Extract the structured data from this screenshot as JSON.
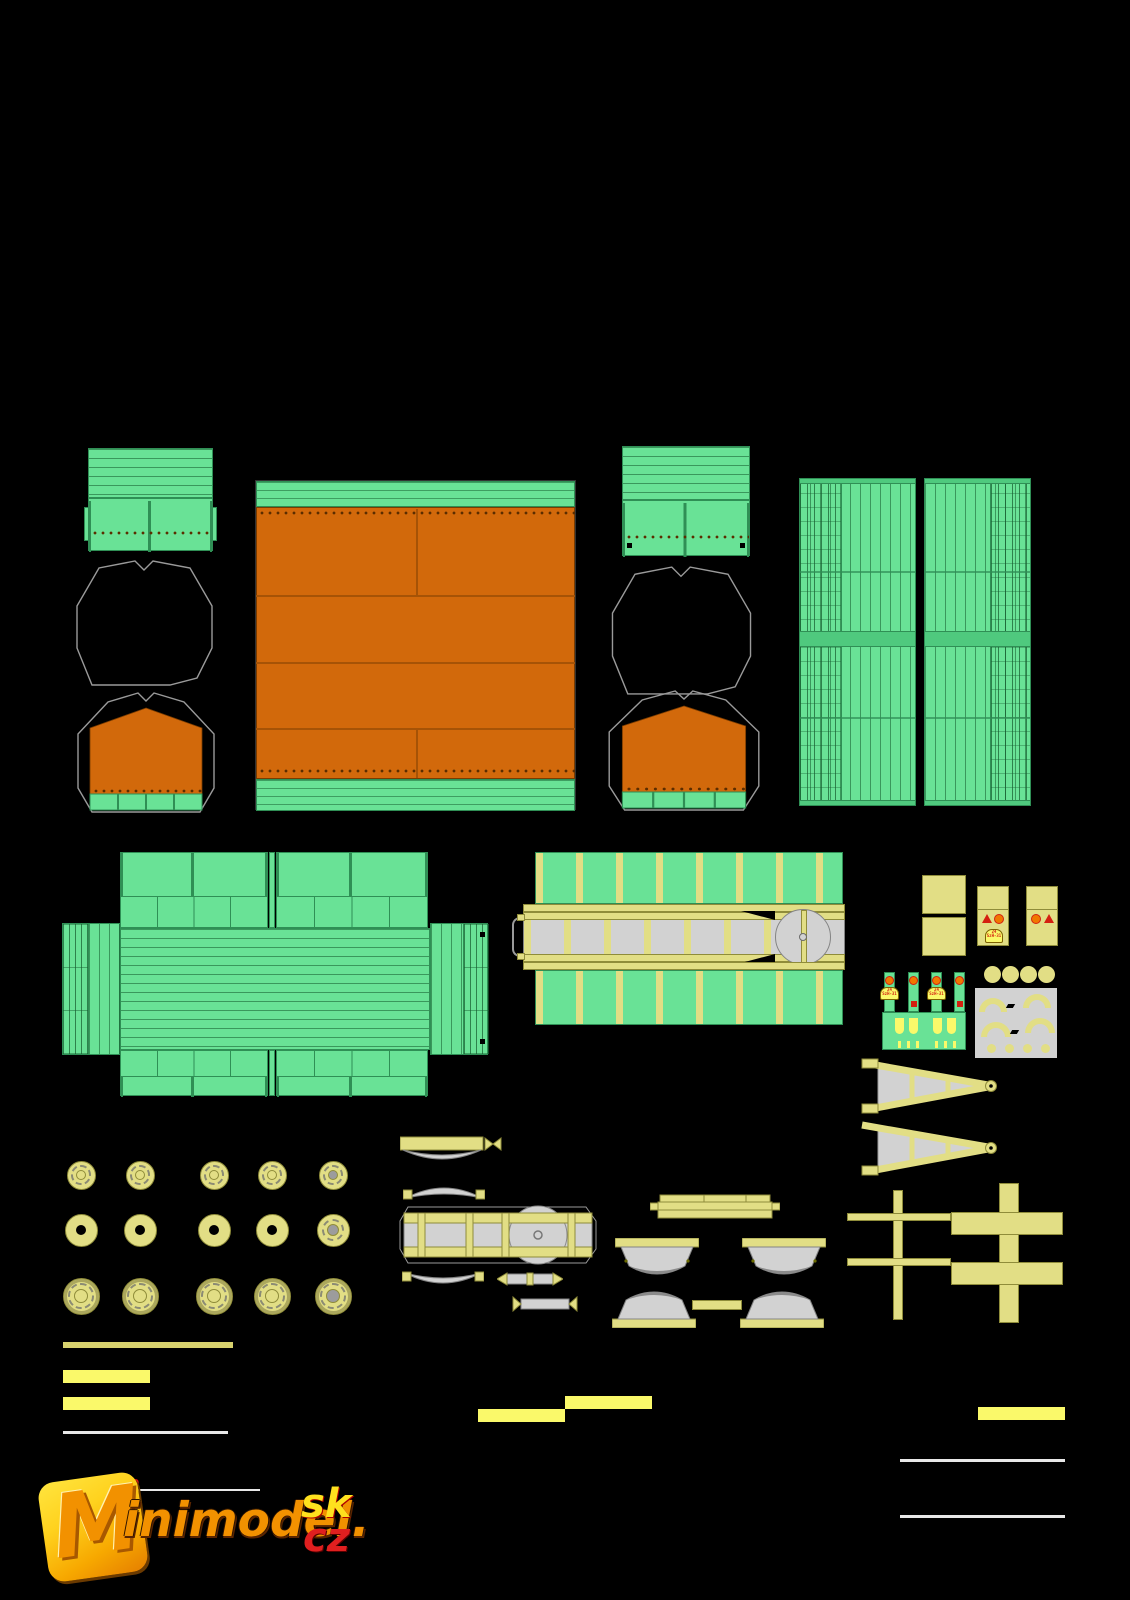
{
  "canvas": {
    "width": 1130,
    "height": 1600,
    "background": "#000000"
  },
  "palette": {
    "bg": "#000000",
    "green": "#69E296",
    "green_dark": "#2F8F55",
    "green_mid": "#4FC97E",
    "orange": "#D2690B",
    "orange_seam": "#A65306",
    "rivet": "#5B2D00",
    "pale_yellow": "#E2DE85",
    "pale_yellow_edge": "#8F8C3A",
    "bright_yellow": "#FAF96A",
    "strip_yellow": "#D8D26E",
    "part_gray": "#D2D2D2",
    "part_gray_edge": "#848484",
    "outline_gray": "#9A9A9A",
    "red": "#D42010",
    "warn_orange": "#F07800",
    "logo_yellow": "#FFD21E",
    "logo_orange": "#F29100",
    "logo_red": "#E01F1F",
    "logo_line": "#E8E8E8"
  },
  "logo": {
    "mark": "M",
    "brand": "inimodel.",
    "domain_sk": "sk",
    "domain_cz": "cz",
    "superscript": "100"
  },
  "decals": {
    "plate_line1": "24",
    "plate_line2": "SzH-31"
  },
  "wheels": {
    "cols_x": [
      81,
      140,
      214,
      272,
      333
    ],
    "rows": [
      {
        "y": 1175,
        "d": 29,
        "style": "face",
        "last": "face gray-hub"
      },
      {
        "y": 1230,
        "d": 33,
        "style": "plain",
        "last": "face gray-hub"
      },
      {
        "y": 1296,
        "d": 37,
        "style": "rim",
        "last": "rim gray-hub"
      }
    ]
  },
  "parts": [
    {
      "name": "headboard-panel-left",
      "desc": "green planked end board of trailer body"
    },
    {
      "name": "headboard-panel-right",
      "desc": "green planked end board of trailer body"
    },
    {
      "name": "canvas-outline-left",
      "desc": "cut outline for tarpaulin end"
    },
    {
      "name": "canvas-outline-right",
      "desc": "cut outline for tarpaulin end"
    },
    {
      "name": "canvas-end-left",
      "desc": "orange tarpaulin end cover with green base strip"
    },
    {
      "name": "canvas-end-right",
      "desc": "orange tarpaulin end cover with green base strip"
    },
    {
      "name": "canvas-top",
      "desc": "large orange tarpaulin with green edge strips and rivet seams"
    },
    {
      "name": "side-panel-left",
      "desc": "tall green side wall, vertical planks"
    },
    {
      "name": "side-panel-right",
      "desc": "tall green side wall, vertical planks"
    },
    {
      "name": "cargo-bed-unfold",
      "desc": "green flat-bed floor with fold-out side and end flaps"
    },
    {
      "name": "chassis-strip",
      "desc": "green skirts with yellow ribs and gray ladder frame with turntable"
    },
    {
      "name": "toolbox-squares",
      "desc": "two plain yellow squares"
    },
    {
      "name": "marker-panels",
      "desc": "yellow panels with red warning triangle and circle decals"
    },
    {
      "name": "lamp-strips",
      "desc": "green strips with orange lamps, red reflectors and license plates"
    },
    {
      "name": "mudflap-strip",
      "desc": "green strip with yellow mud flaps"
    },
    {
      "name": "hub-caps",
      "desc": "four pale yellow discs"
    },
    {
      "name": "fender-sheet",
      "desc": "gray sheet with yellow wheel-arch fenders and dots"
    },
    {
      "name": "tow-triangle-upper",
      "desc": "yellow A-frame drawbar with eye"
    },
    {
      "name": "tow-triangle-lower",
      "desc": "yellow A-frame drawbar with eye"
    },
    {
      "name": "axle-cross-thin",
      "desc": "thin double-cross axle frame"
    },
    {
      "name": "axle-cross-thick",
      "desc": "wide double-cross axle frame"
    },
    {
      "name": "leaf-springs-and-axle",
      "desc": "leaf springs, axle beam with turn circle, drawbar parts"
    },
    {
      "name": "fenders",
      "desc": "four gray mudguards with yellow edges"
    },
    {
      "name": "wheel-set",
      "desc": "fifteen wheel discs in three rows"
    },
    {
      "name": "trim-strips",
      "desc": "yellow and gray trim strips"
    },
    {
      "name": "publisher-logo",
      "desc": "Minimodel.sk / cz publisher logo"
    }
  ]
}
